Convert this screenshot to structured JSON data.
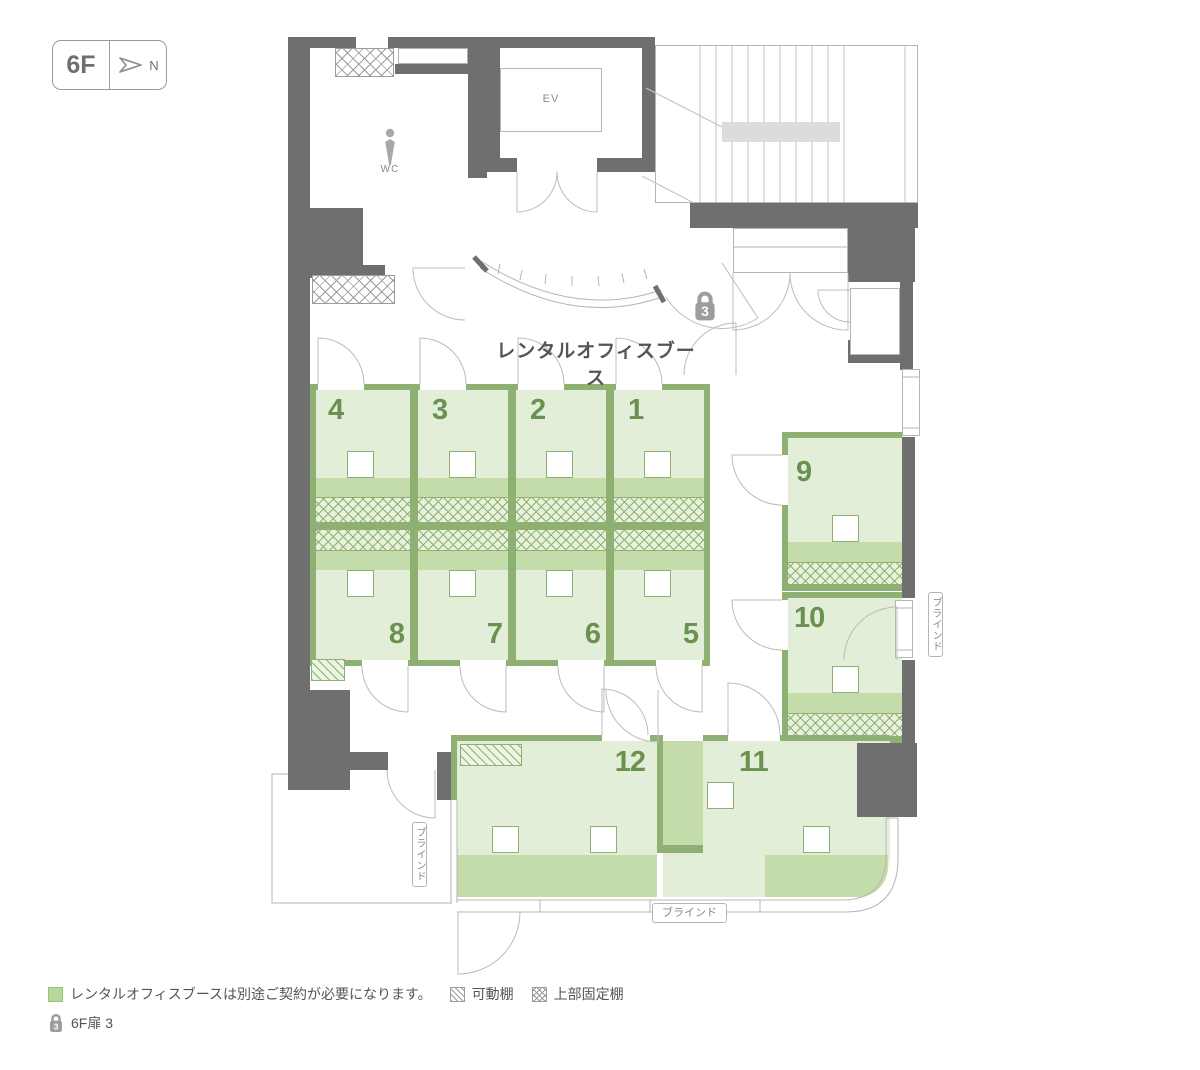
{
  "badge": {
    "floor": "6F",
    "north": "N"
  },
  "title": "レンタルオフィスブース",
  "rooms": {
    "wc": "WC",
    "ev": "EV"
  },
  "booths": [
    "1",
    "2",
    "3",
    "4",
    "5",
    "6",
    "7",
    "8",
    "9",
    "10",
    "11",
    "12"
  ],
  "lock": {
    "count": "3"
  },
  "labels": {
    "blind": "ブラインド"
  },
  "legend": {
    "booth_note": "レンタルオフィスブースは別途ご契約が必要になります。",
    "movable_shelf": "可動棚",
    "fixed_shelf": "上部固定棚",
    "door_note": "6F扉 3"
  },
  "colors": {
    "wall_gray": "#6f6f6f",
    "line_gray": "#b5b5b5",
    "wall_green": "#8fb073",
    "booth_fill": "#e2eed8",
    "desk_green": "#c3dcaa",
    "number_green": "#6a9150",
    "text_gray": "#555555",
    "icon_gray": "#9d9d9d"
  }
}
